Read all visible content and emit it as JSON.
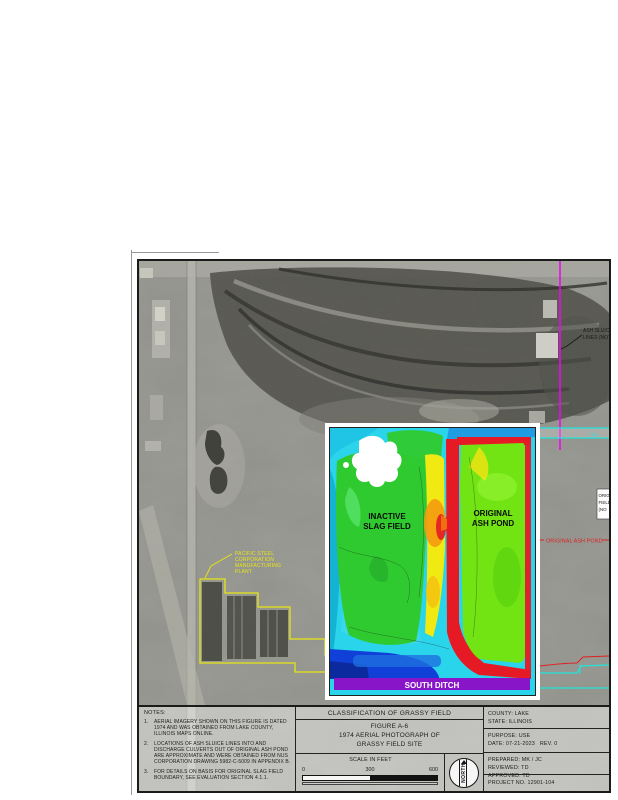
{
  "sheet": {
    "background": "#ffffff"
  },
  "photo": {
    "plant_label": [
      "PACIFIC STEEL",
      "CORPORATION",
      "MANUFACTURING",
      "PLANT"
    ],
    "ash_sluice_label": [
      "ASH SLUICE",
      "LINES (NOT"
    ],
    "original_ash_pond_label": "ORIGINAL ASH POND",
    "ditch_label_cutoff": "NO",
    "boundary_box_label": [
      "ORIG",
      "FIELD",
      "(NO"
    ],
    "colors": {
      "sluice_line": "#ee00ee",
      "ditch_line": "#19e6dd",
      "pond_label": "#e01818",
      "plant_outline": "#e8e80c"
    }
  },
  "overlay": {
    "labels": {
      "inactive": [
        "INACTIVE",
        "SLAG FIELD"
      ],
      "original": [
        "ORIGINAL",
        "ASH POND"
      ],
      "south_ditch": "SOUTH DITCH"
    },
    "colors": {
      "low": "#2ad4ea",
      "mid": "#2fca2f",
      "high": "#f0ea12",
      "very_high": "#f59a10",
      "ridge": "#e61a24",
      "pond": "#72e414",
      "ditch_band": "#8816c8",
      "water": "#1040d8"
    }
  },
  "title_block": {
    "notes_heading": "NOTES:",
    "notes": [
      {
        "num": "1.",
        "text": "AERIAL IMAGERY SHOWN ON THIS FIGURE IS DATED 1974 AND WAS OBTAINED FROM LAKE COUNTY, ILLINOIS MAPS ONLINE."
      },
      {
        "num": "2.",
        "text": "LOCATIONS OF ASH SLUICE LINES INTO AND DISCHARGE CULVERTS OUT OF ORIGINAL ASH POND ARE APPROXIMATE AND WERE OBTAINED FROM NUS CORPORATION DRAWING 5982-C-5009 IN APPENDIX B."
      },
      {
        "num": "3.",
        "text": "FOR DETAILS ON BASIS FOR ORIGINAL SLAG FIELD BOUNDARY, SEE EVALUATION SECTION 4.1.1."
      }
    ],
    "classification_title": "CLASSIFICATION OF GRASSY FIELD",
    "figure_lines": [
      "FIGURE A-6",
      "1974 AERIAL PHOTOGRAPH OF",
      "GRASSY FIELD SITE"
    ],
    "scale": {
      "label": "SCALE IN FEET",
      "ticks": [
        "0",
        "300",
        "600"
      ]
    },
    "north_label": "NORTH",
    "info": {
      "county": "COUNTY: LAKE",
      "state": "STATE: ILLINOIS",
      "purpose": "PURPOSE: USE",
      "date": "DATE: 07-21-2023   REV. 0",
      "prepared": "PREPARED: MK / JC",
      "reviewed": "REVIEWED: TD",
      "approved": "APPROVED: TD",
      "project": "PROJECT NO. 12901-104"
    }
  }
}
